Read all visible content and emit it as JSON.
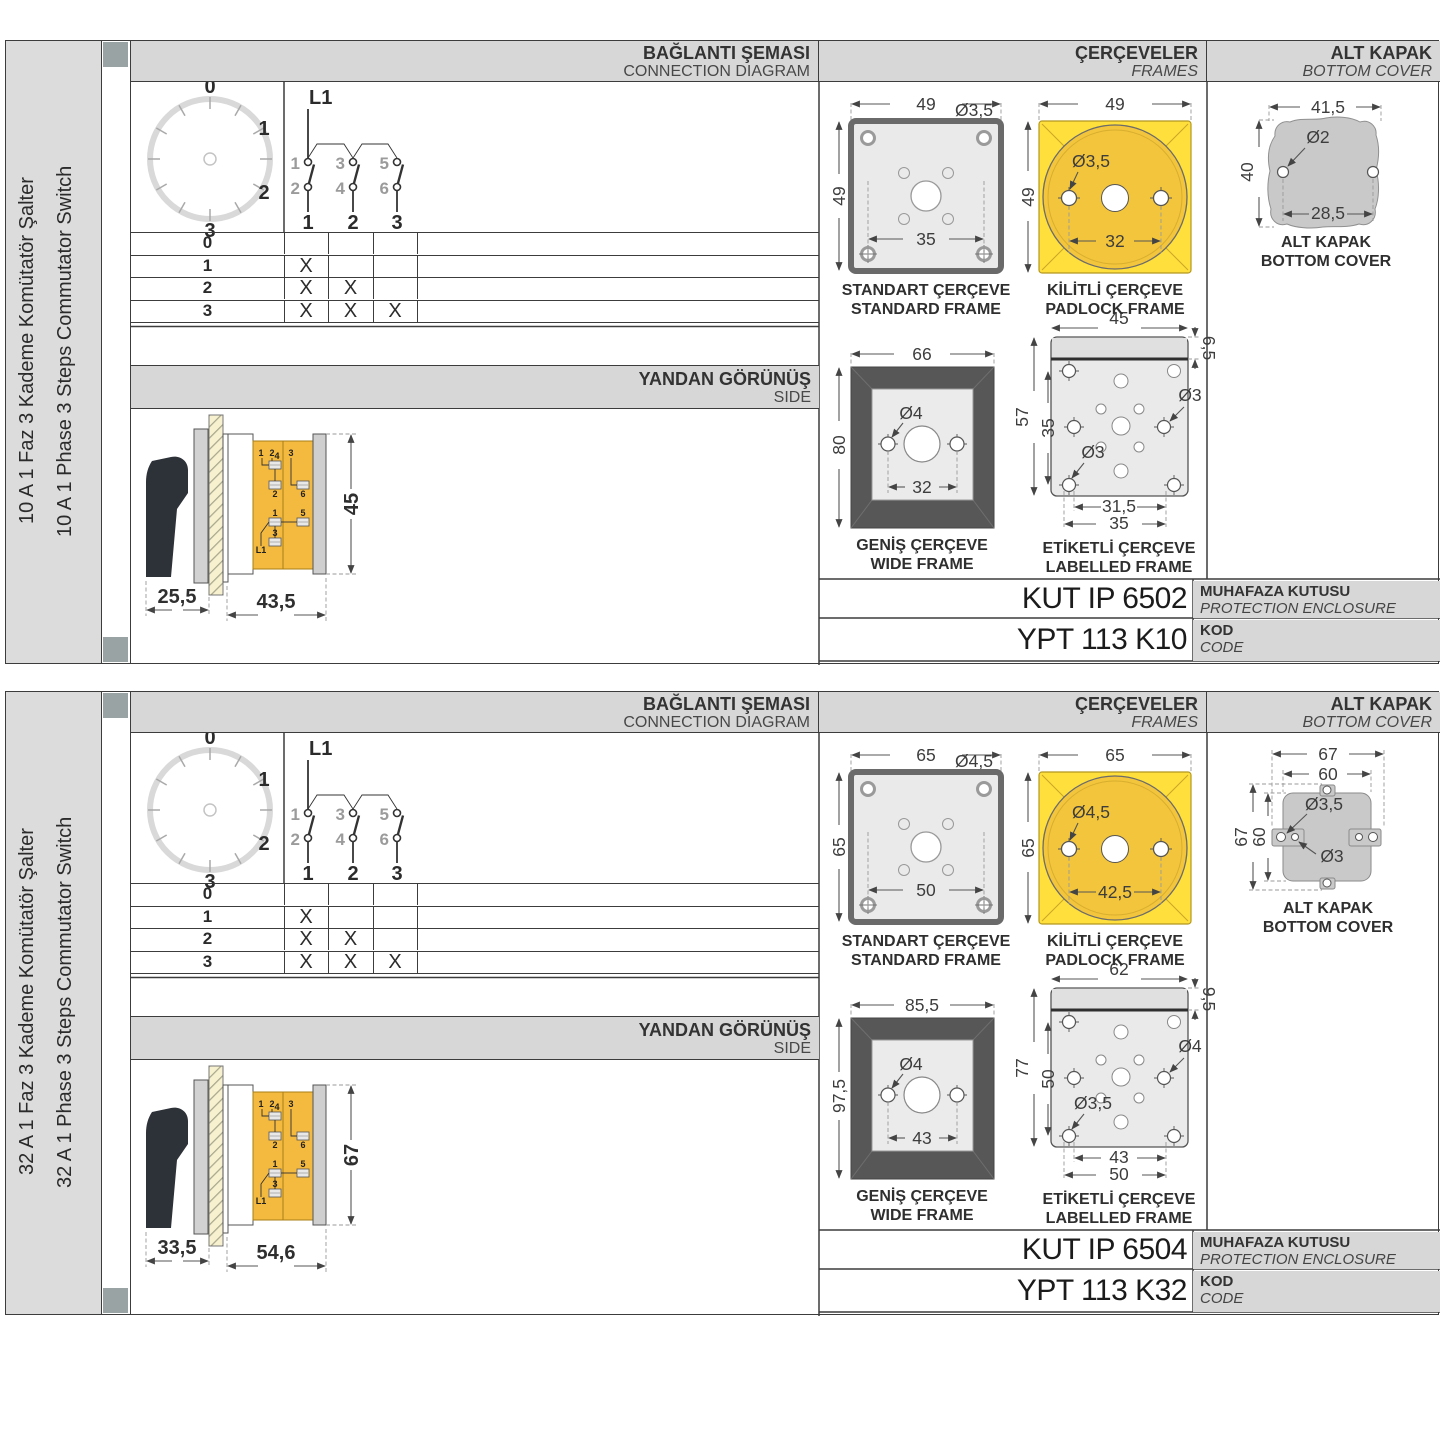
{
  "shared": {
    "headers": {
      "connection_tr": "BAĞLANTI ŞEMASI",
      "connection_en": "CONNECTION DIAGRAM",
      "frames_tr": "ÇERÇEVELER",
      "frames_en": "FRAMES",
      "cover_tr": "ALT KAPAK",
      "cover_en": "BOTTOM COVER",
      "side_tr": "YANDAN GÖRÜNÜŞ",
      "side_en": "SIDE",
      "enclosure_tr": "MUHAFAZA KUTUSU",
      "enclosure_en": "PROTECTION ENCLOSURE",
      "code_tr": "KOD",
      "code_en": "CODE"
    },
    "captions": {
      "standard_tr": "STANDART ÇERÇEVE",
      "standard_en": "STANDARD FRAME",
      "padlock_tr": "KİLİTLİ ÇERÇEVE",
      "padlock_en": "PADLOCK FRAME",
      "wide_tr": "GENİŞ ÇERÇEVE",
      "wide_en": "WIDE FRAME",
      "labelled_tr": "ETİKETLİ ÇERÇEVE",
      "labelled_en": "LABELLED FRAME",
      "cover_tr": "ALT KAPAK",
      "cover_en": "BOTTOM COVER"
    },
    "dial": {
      "p0": "0",
      "p1": "1",
      "p2": "2",
      "p3": "3"
    },
    "contacts": {
      "phase": "L1",
      "t1": "1",
      "t2": "2",
      "t3": "3",
      "t4": "4",
      "t5": "5",
      "t6": "6",
      "pole1": "1",
      "pole2": "2",
      "pole3": "3"
    },
    "table": {
      "steps": [
        "0",
        "1",
        "2",
        "3"
      ],
      "marks": [
        [
          "",
          "",
          ""
        ],
        [
          "X",
          "",
          ""
        ],
        [
          "X",
          "X",
          ""
        ],
        [
          "X",
          "X",
          "X"
        ]
      ]
    },
    "terminals": {
      "a": "1",
      "b": "2",
      "c": "4",
      "d": "2",
      "e": "3",
      "f": "6",
      "g": "1",
      "h": "5",
      "i": "3",
      "j": "L1"
    },
    "colors": {
      "frame_yellow": "#ffdf3c",
      "padlock_orange": "#f3c53c",
      "terminal_yellow": "#f4b93f",
      "panel_gray": "#d7d7d7"
    }
  },
  "sections": [
    {
      "title_tr": "10 A 1 Faz 3 Kademe Komütatör Şalter",
      "title_en": "10 A 1 Phase 3 Steps Commutator Switch",
      "side": {
        "depth1": "25,5",
        "depth2": "43,5",
        "height": "45"
      },
      "standard": {
        "w": "49",
        "h": "49",
        "hole": "Ø3,5",
        "pitch": "35"
      },
      "padlock": {
        "w": "49",
        "h": "49",
        "hole": "Ø3,5",
        "pitch": "32"
      },
      "wide": {
        "w": "66",
        "h": "80",
        "hole": "Ø4",
        "pitch": "32"
      },
      "labelled": {
        "w": "45",
        "band": "6,5",
        "h": "57",
        "inner": "35",
        "hole_right": "Ø3",
        "hole_left": "Ø3",
        "pitch1": "31,5",
        "pitch2": "35"
      },
      "cover": {
        "w": "41,5",
        "hole": "Ø2",
        "h": "40",
        "pitch": "28,5"
      },
      "enclosure_code": "KUT IP 6502",
      "product_code": "YPT 113 K10"
    },
    {
      "title_tr": "32 A 1 Faz 3 Kademe Komütatör Şalter",
      "title_en": "32 A 1 Phase 3 Steps Commutator Switch",
      "side": {
        "depth1": "33,5",
        "depth2": "54,6",
        "height": "67"
      },
      "standard": {
        "w": "65",
        "h": "65",
        "hole": "Ø4,5",
        "pitch": "50"
      },
      "padlock": {
        "w": "65",
        "h": "65",
        "hole": "Ø4,5",
        "pitch": "42,5"
      },
      "wide": {
        "w": "85,5",
        "h": "97,5",
        "hole": "Ø4",
        "pitch": "43"
      },
      "labelled": {
        "w": "62",
        "band": "9,5",
        "h": "77",
        "inner": "50",
        "hole_right": "Ø4",
        "hole_left": "Ø3,5",
        "pitch1": "43",
        "pitch2": "50"
      },
      "cover": {
        "w1": "67",
        "w2": "60",
        "hole1": "Ø3,5",
        "hole2": "Ø3",
        "h1": "67",
        "h2": "60"
      },
      "enclosure_code": "KUT IP 6504",
      "product_code": "YPT 113 K32"
    }
  ]
}
